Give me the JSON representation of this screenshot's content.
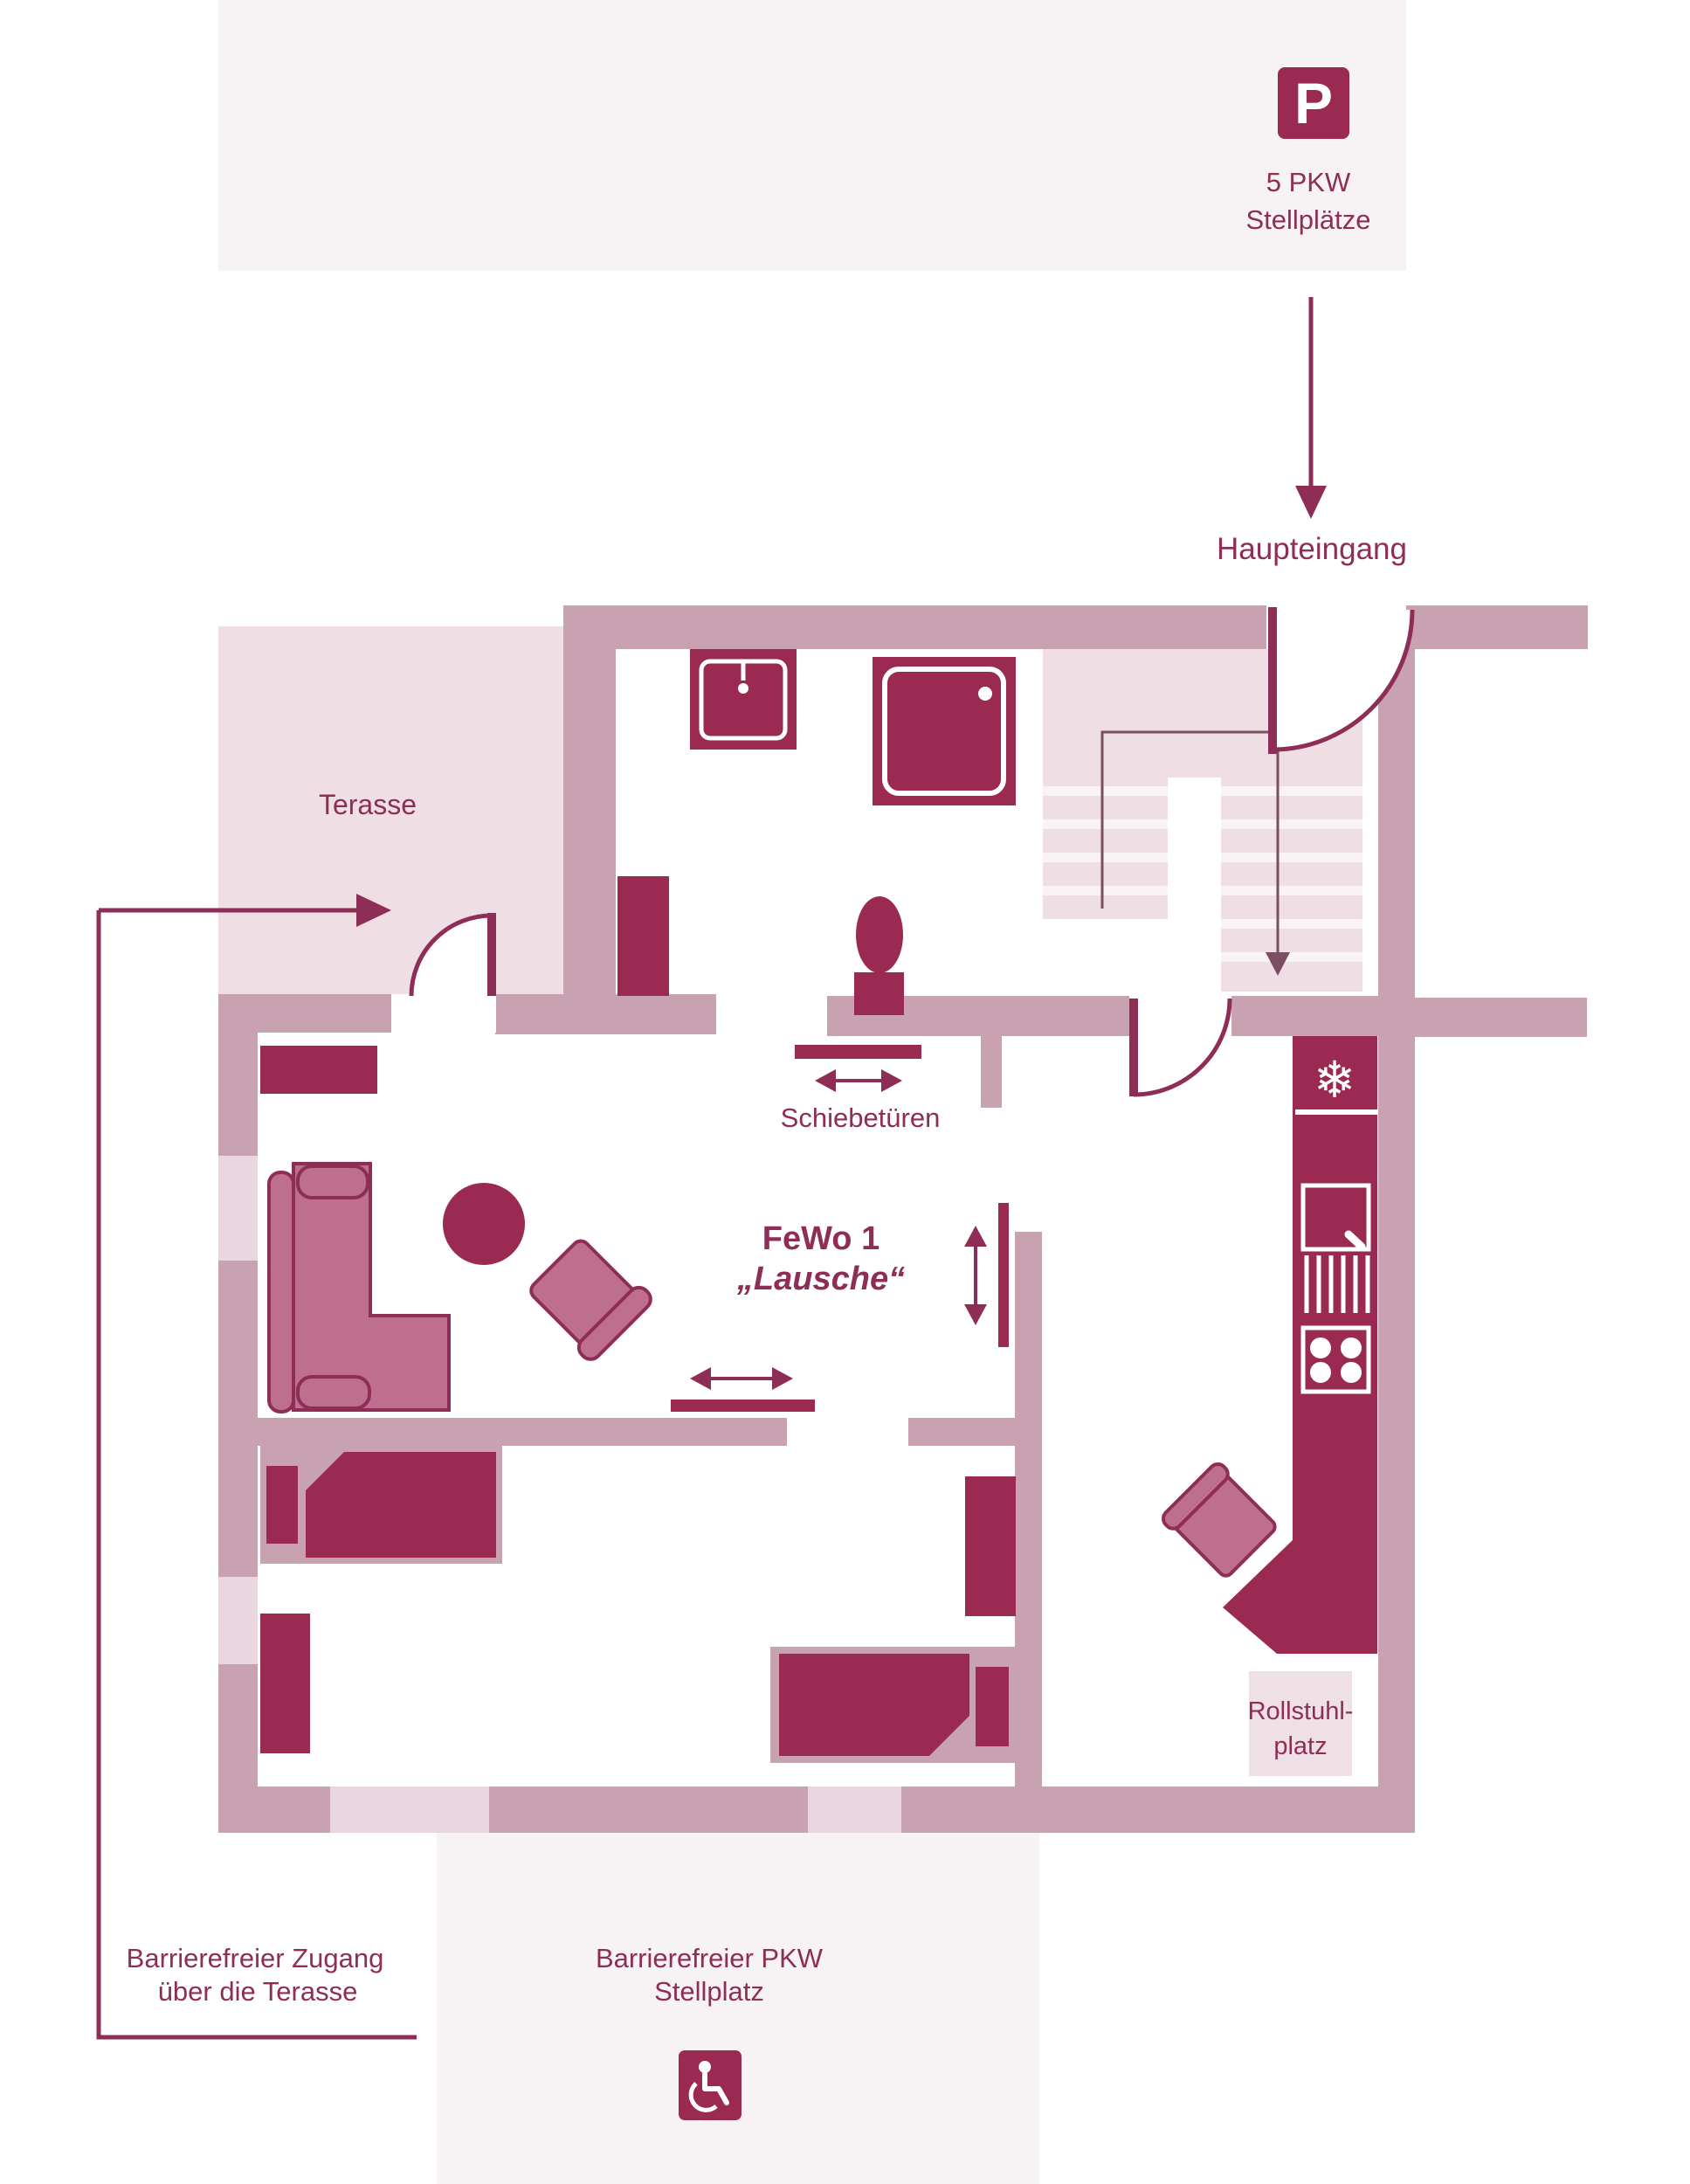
{
  "colors": {
    "accent_dark": "#9A2A52",
    "wall": "#C9A2B1",
    "area_light": "#EFDFE5",
    "block_bg": "#F7F2F3",
    "window": "#E9D6DE",
    "furniture": "#BE6F8E",
    "text": "#8E2D55",
    "white": "#FFFFFF"
  },
  "parking": {
    "sign_letter": "P",
    "count_line1": "5 PKW",
    "count_line2": "Stellplätze"
  },
  "entrance": {
    "label": "Haupteingang"
  },
  "terrace": {
    "label": "Terasse"
  },
  "doors": {
    "sliding_label": "Schiebetüren"
  },
  "apartment": {
    "name_line1": "FeWo 1",
    "name_line2": "„Lausche“"
  },
  "kitchen": {
    "wheelchair_space_line1": "Rollstuhl-",
    "wheelchair_space_line2": "platz"
  },
  "accessibility": {
    "terrace_access_line1": "Barrierefreier Zugang",
    "terrace_access_line2": "über die Terasse",
    "parking_line1": "Barrierefreier PKW",
    "parking_line2": "Stellplatz"
  },
  "icons": {
    "snowflake_glyph": "❄"
  }
}
